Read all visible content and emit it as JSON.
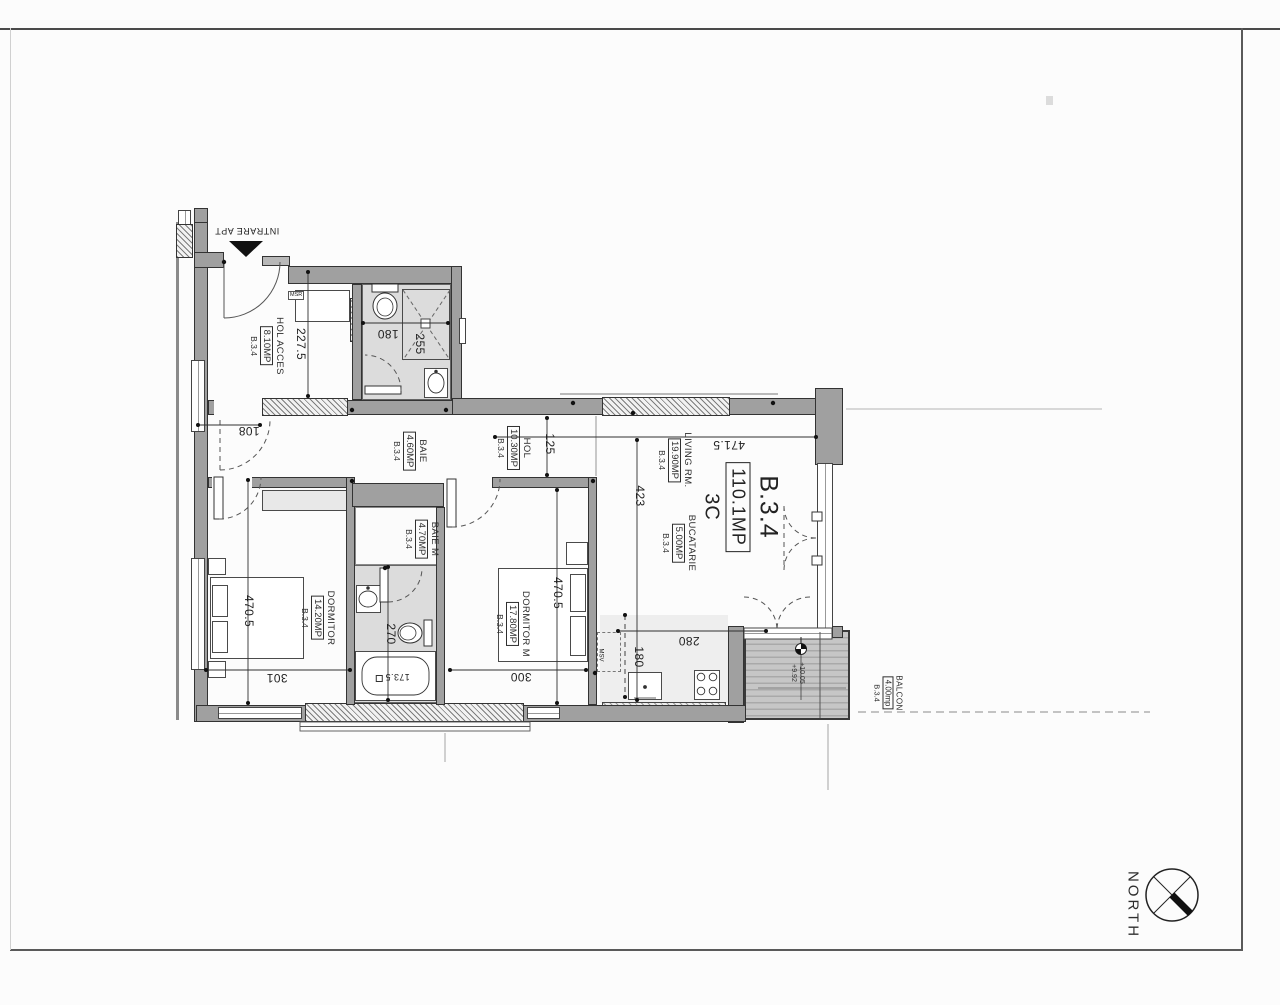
{
  "plan": {
    "title": {
      "code": "B.3.4",
      "area": "110.1MP",
      "type": "3C"
    },
    "entrance": {
      "label": "INTRARE APT"
    },
    "rooms": [
      {
        "id": "hol-acces",
        "name": "HOL ACCES",
        "area": "8.10MP",
        "unit": "B.3.4"
      },
      {
        "id": "baie",
        "name": "BAIE",
        "area": "4.60MP",
        "unit": "B.3.4"
      },
      {
        "id": "hol",
        "name": "HOL",
        "area": "10.30MP",
        "unit": "B.3.4"
      },
      {
        "id": "living",
        "name": "LIVING RM.",
        "area": "19.90MP",
        "unit": "B.3.4"
      },
      {
        "id": "bucatarie",
        "name": "BUCATARIE",
        "area": "5.00MP",
        "unit": "B.3.4"
      },
      {
        "id": "baie-m",
        "name": "BAIE M",
        "area": "4.70MP",
        "unit": "B.3.4"
      },
      {
        "id": "dormitor",
        "name": "DORMITOR",
        "area": "14.20MP",
        "unit": "B.3.4"
      },
      {
        "id": "dormitor-m",
        "name": "DORMITOR M",
        "area": "17.80MP",
        "unit": "B.3.4"
      },
      {
        "id": "balcon",
        "name": "BALCON",
        "area": "4.00mp",
        "unit": "B.3.4"
      }
    ],
    "dims": {
      "d227_5": "227.5",
      "d180_baie": "180",
      "d255": "255",
      "d108": "108",
      "d125": "125",
      "d471_5": "471.5",
      "d423": "423",
      "d470_5_dormitor": "470.5",
      "d470_5_dormitor_m": "470.5",
      "d270": "270",
      "d301": "301",
      "d300": "300",
      "d280": "280",
      "d180_bucatarie": "180",
      "d173_5": "173.5"
    },
    "levels": {
      "upper": "+10.05",
      "lower": "+9.92"
    },
    "tags": {
      "washer": "MSR",
      "dishwasher": "MSV"
    },
    "compass": {
      "label": "NORTH"
    },
    "colors": {
      "wall": "#a0a0a0",
      "wet_floor": "#dcdcdc",
      "paper": "#fcfcfc",
      "ink": "#2a2a2a"
    }
  }
}
